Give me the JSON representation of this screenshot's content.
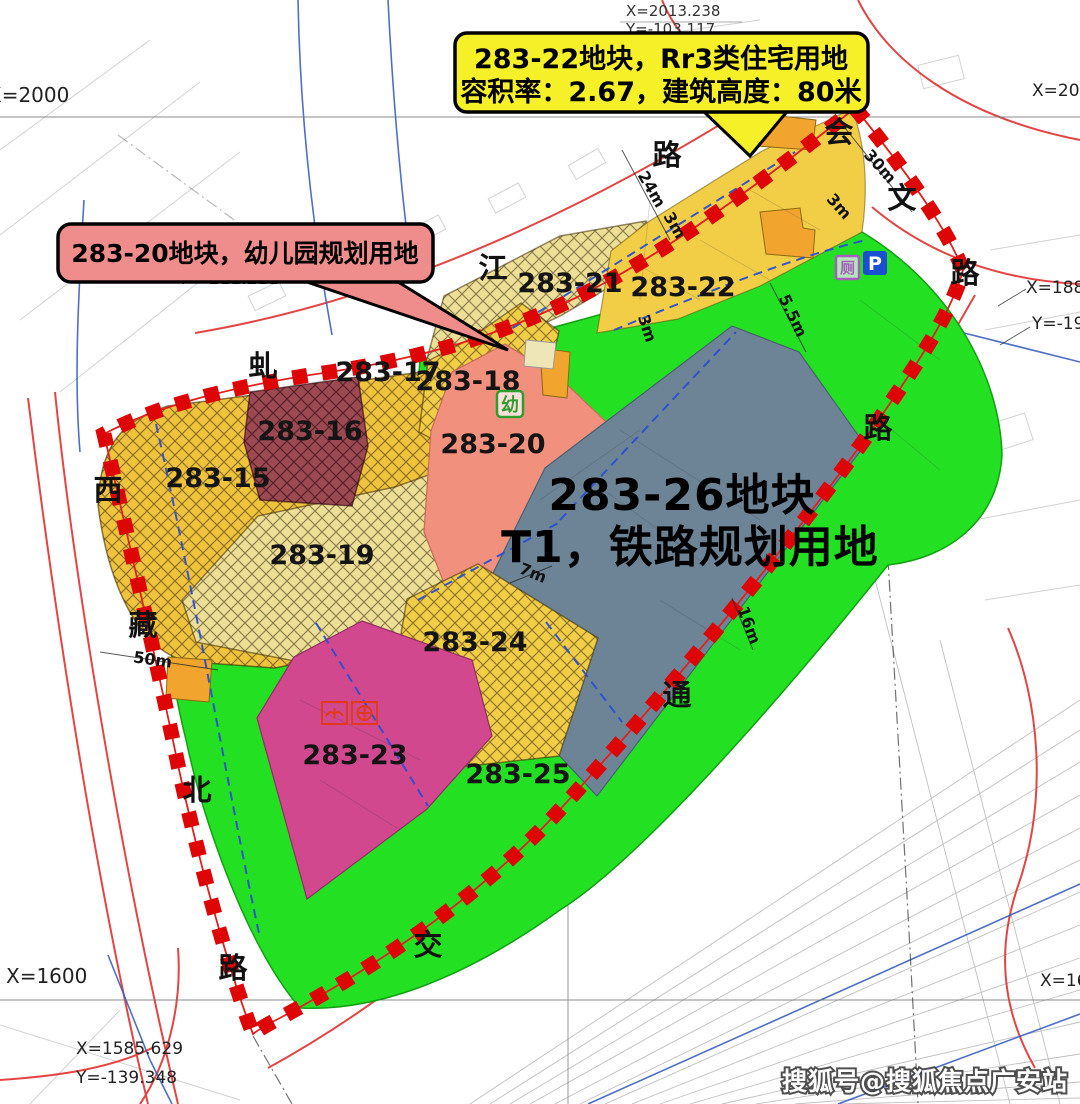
{
  "map": {
    "title_callout": {
      "line1": "283-22地块，Rr3类住宅用地",
      "line2": "容积率：2.67，建筑高度：80米"
    },
    "kindergarten_callout": {
      "text": "283-20地块，幼儿园规划用地"
    },
    "center_label": {
      "line1": "283-26地块",
      "line2": "T1，铁路规划用地"
    },
    "parcels": [
      {
        "label": "283-15"
      },
      {
        "label": "283-16"
      },
      {
        "label": "283-17"
      },
      {
        "label": "283-18"
      },
      {
        "label": "283-19"
      },
      {
        "label": "283-20"
      },
      {
        "label": "283-21"
      },
      {
        "label": "283-22"
      },
      {
        "label": "283-23"
      },
      {
        "label": "283-24"
      },
      {
        "label": "283-25"
      }
    ],
    "roads": {
      "qiujiang": {
        "name": "虬江路",
        "chars": [
          "虬",
          "江",
          "路"
        ]
      },
      "xizangbei": {
        "name": "西藏北路",
        "chars": [
          "西",
          "藏",
          "北",
          "路"
        ]
      },
      "huiwen": {
        "name": "会文路",
        "chars": [
          "会",
          "文",
          "路"
        ]
      },
      "jiaotong": {
        "name": "交通路",
        "chars": [
          "交",
          "通",
          "路"
        ]
      }
    },
    "coords": {
      "top_left": "X=2000",
      "top_mid_x": "X=2013.238",
      "top_mid_y": "Y=-103.117",
      "top_right": "X=2000",
      "right_x": "X=1888.",
      "right_y": "Y=-192.",
      "mid_y": "Y=-211.211",
      "bottom_left": "X=1600",
      "bottom_x": "X=1585.629",
      "bottom_y": "Y=-139.348",
      "bottom_right": "X=1600"
    },
    "dimensions": [
      "24m",
      "3m",
      "30m",
      "3m",
      "3m",
      "5.5m",
      "7m",
      "16m",
      "50m"
    ],
    "icons": {
      "kindergarten": "幼",
      "toilet": "厕",
      "parking": "P"
    },
    "watermark": "搜狐号@搜狐焦点广安站"
  },
  "colors": {
    "green": "#23E023",
    "yellow_deep": "#EFC33C",
    "yellow_pale": "#EDE096",
    "yellow_bright": "#F2CE47",
    "maroon": "#9C4A52",
    "salmon": "#F2907E",
    "gray_blue": "#6D8496",
    "magenta": "#D2488E",
    "orange": "#F2A52E",
    "boundary_red": "#DD0505",
    "callout_yellow": "#F6F029",
    "callout_pink": "#EF8C8C"
  }
}
